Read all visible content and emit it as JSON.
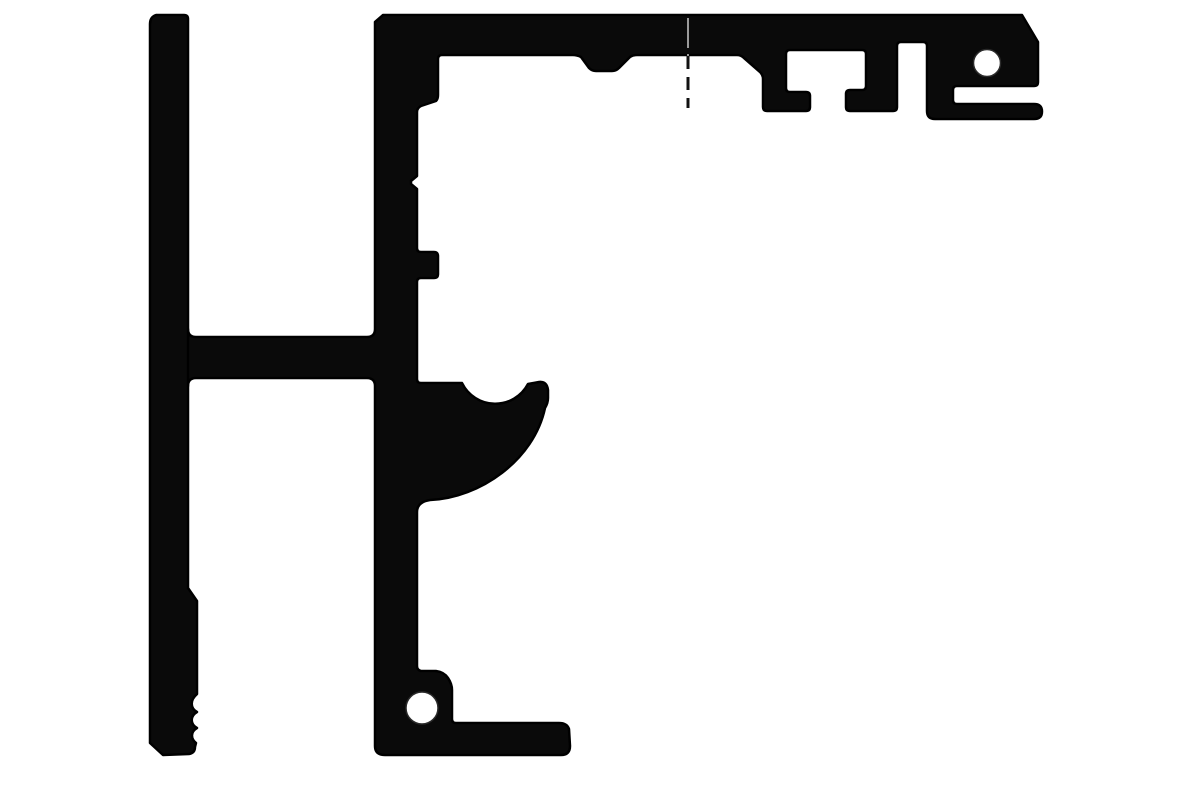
{
  "canvas": {
    "width": 1200,
    "height": 800,
    "background": "#ffffff"
  },
  "colors": {
    "profile_fill": "#0a0a0a",
    "profile_outline": "#000000",
    "hole_fill": "#ffffff",
    "centerline_dark": "#111111",
    "centerline_light": "#9a9a9a"
  },
  "shapes": {
    "left_bar_path": "M156,15 L184,15 Q188,15 188,19 L188,588 L197,601 L197,694 C190,700 190,708 197,712 C190,716 190,724 197,728 C190,732 191,739 196,743 L195,747 Q195,753 189,754 L163,755 L150,743 L150,24 Q150,17 156,15 Z",
    "main_profile_path": "M383,15 L1022,15 L1038,42 L1038,82 Q1038,86 1034,86 L957,86 Q953,86 953,90 L953,100 Q953,104 957,104 L1034,104 Q1042,104 1042,111.5 Q1042,119 1034,119 L935,119 Q927,119 927,111 L927,46 Q927,42 923,42 L901,42 Q897,42 897,46 L897,107 Q897,111 893,111 L850,111 Q846,111 846,107 L846,94 Q846,90 850,90 L862,90 Q866,90 866,86 L866,54 Q866,50 862,50 L790,50 Q786,50 786,54 L786,88 Q786,92 790,92 L806,92 Q810,92 810,96 L810,107 Q810,111 806,111 L767,111 Q763,111 763,107 L763,79 Q763,75 760,72 L744,58 Q741,55 737,55 L637,55 Q633,55 630,57 L619,68 Q616,71 612,71 L596,71 Q592,71 589,68 L581,57 Q577,55 573,55 L442,55 Q438,55 438,59 L438,95 Q438,99 436,101 L421,106 Q417,108 417,112 L417,176 L411,181 L411,184 L417,189 L417,248 Q417,252 421,252 L434,252 Q438,252 438,256 L438,274 Q438,278 434,278 L421,278 Q417,278 417,282 L417,379 Q417,383 421,383 L462,383 A37,37 0 0 0 528,384 L539,382 Q547,381 548,390 L548,398 Q548,403 545,408 C534,460 480,498 430,500 Q417,502 417,512 L417,666 Q417,670 421,671 L436,671 Q444,672 448,678 Q452,684 452,690 L452,719 Q452,723 456,723 L559,723 Q567,723 569,729 L570,746 Q570,755 561,755 L385,755 Q375,755 375,746 L375,386 Q375,378 367,378 L196,378 Q188,378 188,386 L180,386 L180,330 L188,329 Q188,337 196,337 L367,337 Q375,337 375,329 L375,22 Z"
  },
  "holes": {
    "top_right": {
      "cx": 987,
      "cy": 63,
      "r": 13.5
    },
    "bottom_left": {
      "cx": 422,
      "cy": 708,
      "r": 16
    }
  },
  "centerline": {
    "x": 688,
    "y_top": 18,
    "y_mid": 56,
    "y_bottom": 108,
    "dash_on_black": "30 6",
    "dash_on_white": "13 8",
    "width_on_black": 2,
    "width_on_white": 3
  }
}
